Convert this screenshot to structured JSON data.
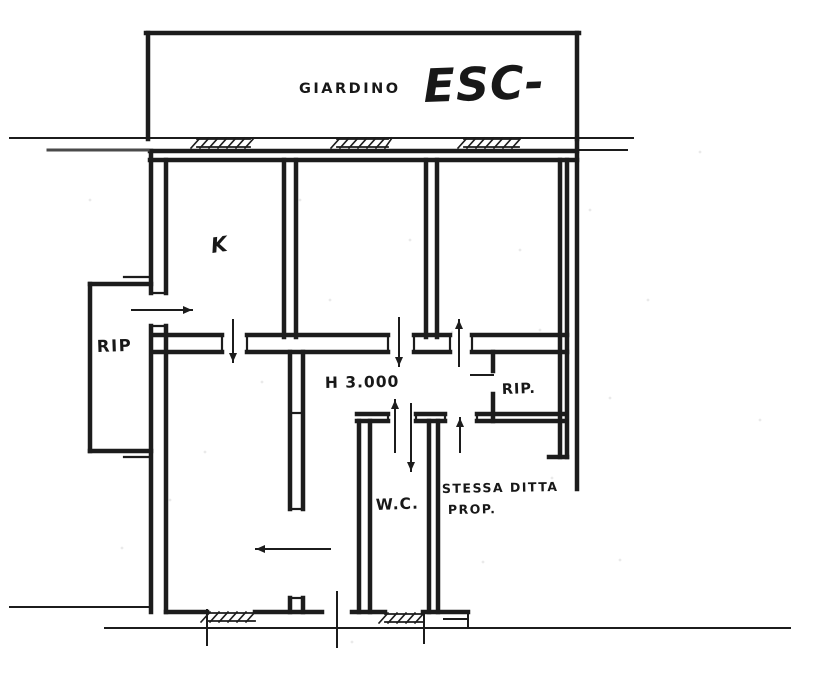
{
  "document": {
    "kind": "scanned hand-drawn floor plan",
    "ink_color": "#1c1c1c",
    "paper_color": "#ffffff",
    "boundary_line_color": "#4a4a4a"
  },
  "labels": {
    "giardino": {
      "text": "GIARDINO",
      "x": 299,
      "y": 93,
      "size": 14.5,
      "weight": "bold",
      "style": "normal",
      "spacing": 2.5,
      "rotate": 0
    },
    "esc": {
      "text": "ESC-",
      "x": 424,
      "y": 102,
      "size": 46,
      "weight": "bold",
      "style": "italic",
      "spacing": 1,
      "rotate": -2
    },
    "k": {
      "text": "K",
      "x": 212,
      "y": 253,
      "size": 21,
      "weight": "bold",
      "style": "italic",
      "spacing": 0,
      "rotate": -8
    },
    "rip_left": {
      "text": "RIP",
      "x": 97,
      "y": 352,
      "size": 16.5,
      "weight": "bold",
      "style": "normal",
      "spacing": 1.5,
      "rotate": -2
    },
    "h_ceiling": {
      "text": "H 3.000",
      "x": 325,
      "y": 388,
      "size": 15.5,
      "weight": "bold",
      "style": "normal",
      "spacing": 1,
      "rotate": -1
    },
    "rip_right": {
      "text": "RIP.",
      "x": 502,
      "y": 394,
      "size": 14.5,
      "weight": "bold",
      "style": "normal",
      "spacing": 1,
      "rotate": -2
    },
    "wc": {
      "text": "W.C.",
      "x": 376,
      "y": 510,
      "size": 15.5,
      "weight": "bold",
      "style": "normal",
      "spacing": 1,
      "rotate": -2
    },
    "stessa_ditta": {
      "text": "STESSA DITTA",
      "x": 442,
      "y": 493,
      "size": 12.5,
      "weight": "bold",
      "style": "normal",
      "spacing": 1.5,
      "rotate": -1
    },
    "prop": {
      "text": "PROP.",
      "x": 448,
      "y": 514,
      "size": 12.5,
      "weight": "bold",
      "style": "normal",
      "spacing": 1.5,
      "rotate": -1
    }
  },
  "plan": {
    "walls": [
      [
        148,
        33,
        148,
        139
      ],
      [
        146,
        33,
        579,
        33
      ],
      [
        577,
        33,
        577,
        139
      ],
      [
        150,
        151,
        577,
        151
      ],
      [
        150,
        160,
        577,
        160
      ],
      [
        151,
        151,
        151,
        293
      ],
      [
        151,
        326,
        151,
        612
      ],
      [
        166,
        160,
        166,
        293
      ],
      [
        166,
        326,
        166,
        612
      ],
      [
        90,
        284,
        151,
        284
      ],
      [
        90,
        284,
        90,
        451
      ],
      [
        90,
        451,
        151,
        451
      ],
      [
        284,
        160,
        284,
        337
      ],
      [
        296,
        160,
        296,
        337
      ],
      [
        426,
        160,
        426,
        337
      ],
      [
        437,
        160,
        437,
        337
      ],
      [
        560,
        160,
        560,
        457
      ],
      [
        567,
        160,
        567,
        457
      ],
      [
        549,
        457,
        567,
        457
      ],
      [
        577,
        139,
        577,
        489
      ],
      [
        152,
        335,
        222,
        335
      ],
      [
        247,
        335,
        388,
        335
      ],
      [
        414,
        335,
        450,
        335
      ],
      [
        472,
        335,
        567,
        335
      ],
      [
        152,
        352,
        222,
        352
      ],
      [
        247,
        352,
        388,
        352
      ],
      [
        414,
        352,
        450,
        352
      ],
      [
        472,
        352,
        567,
        352
      ],
      [
        357,
        414,
        388,
        414
      ],
      [
        416,
        414,
        445,
        414
      ],
      [
        477,
        414,
        563,
        414
      ],
      [
        357,
        421,
        388,
        421
      ],
      [
        416,
        421,
        445,
        421
      ],
      [
        477,
        421,
        563,
        421
      ],
      [
        493,
        352,
        493,
        371
      ],
      [
        493,
        394,
        493,
        421
      ],
      [
        290,
        352,
        290,
        509
      ],
      [
        290,
        598,
        290,
        612
      ],
      [
        303,
        352,
        303,
        509
      ],
      [
        303,
        598,
        303,
        612
      ],
      [
        359,
        421,
        359,
        612
      ],
      [
        370,
        421,
        370,
        612
      ],
      [
        429,
        421,
        429,
        612
      ],
      [
        438,
        421,
        438,
        612
      ],
      [
        166,
        612,
        207,
        612
      ],
      [
        255,
        612,
        322,
        612
      ],
      [
        352,
        612,
        385,
        612
      ],
      [
        423,
        612,
        468,
        612
      ]
    ],
    "thin": [
      [
        10,
        138,
        633,
        138
      ],
      [
        573,
        150,
        627,
        150
      ],
      [
        10,
        607,
        151,
        607
      ],
      [
        105,
        628,
        790,
        628
      ],
      [
        468,
        612,
        468,
        628
      ],
      [
        207,
        610,
        207,
        645
      ],
      [
        337,
        592,
        337,
        647
      ],
      [
        424,
        613,
        424,
        643
      ],
      [
        444,
        613,
        468,
        613
      ],
      [
        444,
        619,
        468,
        619
      ]
    ],
    "gray": [
      [
        48,
        150,
        148,
        150
      ]
    ],
    "ticks": [
      [
        151,
        293,
        166,
        293
      ],
      [
        151,
        326,
        166,
        326
      ],
      [
        222,
        335,
        222,
        352
      ],
      [
        247,
        335,
        247,
        352
      ],
      [
        388,
        335,
        388,
        352
      ],
      [
        414,
        335,
        414,
        352
      ],
      [
        450,
        335,
        450,
        352
      ],
      [
        472,
        335,
        472,
        352
      ],
      [
        388,
        414,
        388,
        421
      ],
      [
        416,
        414,
        416,
        421
      ],
      [
        445,
        414,
        445,
        421
      ],
      [
        477,
        414,
        477,
        421
      ],
      [
        290,
        413,
        303,
        413
      ],
      [
        290,
        509,
        303,
        509
      ],
      [
        290,
        598,
        303,
        598
      ],
      [
        124,
        277,
        151,
        277
      ],
      [
        124,
        457,
        151,
        457
      ]
    ],
    "windows": [
      {
        "x1": 197,
        "x2": 250,
        "y1": 139,
        "y2": 147
      },
      {
        "x1": 337,
        "x2": 388,
        "y1": 139,
        "y2": 147
      },
      {
        "x1": 464,
        "x2": 519,
        "y1": 139,
        "y2": 147
      },
      {
        "x1": 207,
        "x2": 255,
        "y1": 613,
        "y2": 621
      },
      {
        "x1": 385,
        "x2": 423,
        "y1": 614,
        "y2": 622
      }
    ],
    "arrows": [
      {
        "x1": 132,
        "y1": 310,
        "x2": 192,
        "y2": 310,
        "head": "end"
      },
      {
        "x1": 233,
        "y1": 320,
        "x2": 233,
        "y2": 362,
        "head": "end"
      },
      {
        "x1": 399,
        "y1": 318,
        "x2": 399,
        "y2": 366,
        "head": "end"
      },
      {
        "x1": 459,
        "y1": 366,
        "x2": 459,
        "y2": 320,
        "head": "end"
      },
      {
        "x1": 395,
        "y1": 452,
        "x2": 395,
        "y2": 400,
        "head": "end"
      },
      {
        "x1": 411,
        "y1": 404,
        "x2": 411,
        "y2": 471,
        "head": "end"
      },
      {
        "x1": 460,
        "y1": 452,
        "x2": 460,
        "y2": 418,
        "head": "end"
      },
      {
        "x1": 330,
        "y1": 549,
        "x2": 256,
        "y2": 549,
        "head": "end"
      },
      {
        "x1": 471,
        "y1": 375,
        "x2": 493,
        "y2": 375,
        "head": "none"
      }
    ],
    "specks": [
      [
        300,
        200
      ],
      [
        520,
        250
      ],
      [
        452,
        332
      ],
      [
        610,
        398
      ],
      [
        205,
        452
      ],
      [
        483,
        562
      ],
      [
        352,
        642
      ],
      [
        648,
        300
      ],
      [
        122,
        548
      ],
      [
        700,
        152
      ],
      [
        552,
        478
      ],
      [
        262,
        382
      ],
      [
        590,
        210
      ],
      [
        330,
        300
      ],
      [
        170,
        500
      ],
      [
        620,
        560
      ],
      [
        90,
        200
      ],
      [
        760,
        420
      ],
      [
        410,
        240
      ],
      [
        540,
        330
      ]
    ]
  }
}
